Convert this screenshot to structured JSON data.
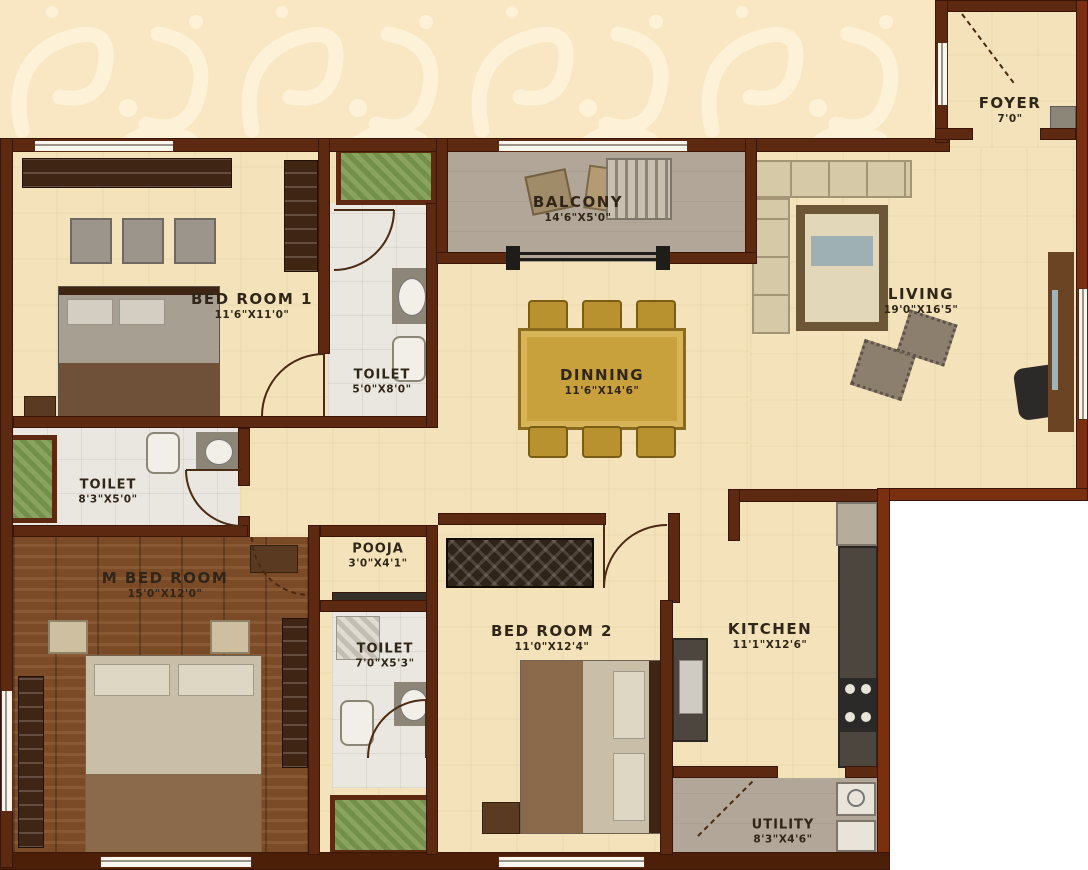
{
  "plan_colors": {
    "wall": "#5d2a11",
    "wall_exterior": "#7a3010",
    "floor_cream": "#f4e3ba",
    "floor_wood": "#7b4a27",
    "floor_tile": "#e9e7df",
    "floor_balcony": "#b2a698",
    "planter_green": "#7f9b55",
    "dining_gold": "#c8a03c",
    "label_text": "#2f2518",
    "wallpaper_cream": "#f8e7c2",
    "outside_white": "#ffffff"
  },
  "rooms": {
    "foyer": {
      "name": "FOYER",
      "dim": "7'0\""
    },
    "living": {
      "name": "LIVING",
      "dim": "19'0\"X16'5\""
    },
    "balcony": {
      "name": "BALCONY",
      "dim": "14'6\"X5'0\""
    },
    "bedroom1": {
      "name": "BED ROOM 1",
      "dim": "11'6\"X11'0\""
    },
    "toilet1": {
      "name": "TOILET",
      "dim": "5'0\"X8'0\""
    },
    "dinning": {
      "name": "DINNING",
      "dim": "11'6\"X14'6\""
    },
    "toilet2": {
      "name": "TOILET",
      "dim": "8'3\"X5'0\""
    },
    "mbedroom": {
      "name": "M BED ROOM",
      "dim": "15'0\"X12'0\""
    },
    "pooja": {
      "name": "POOJA",
      "dim": "3'0\"X4'1\""
    },
    "toilet3": {
      "name": "TOILET",
      "dim": "7'0\"X5'3\""
    },
    "bedroom2": {
      "name": "BED ROOM 2",
      "dim": "11'0\"X12'4\""
    },
    "kitchen": {
      "name": "KITCHEN",
      "dim": "11'1\"X12'6\""
    },
    "utility": {
      "name": "UTILITY",
      "dim": "8'3\"X4'6\""
    }
  }
}
